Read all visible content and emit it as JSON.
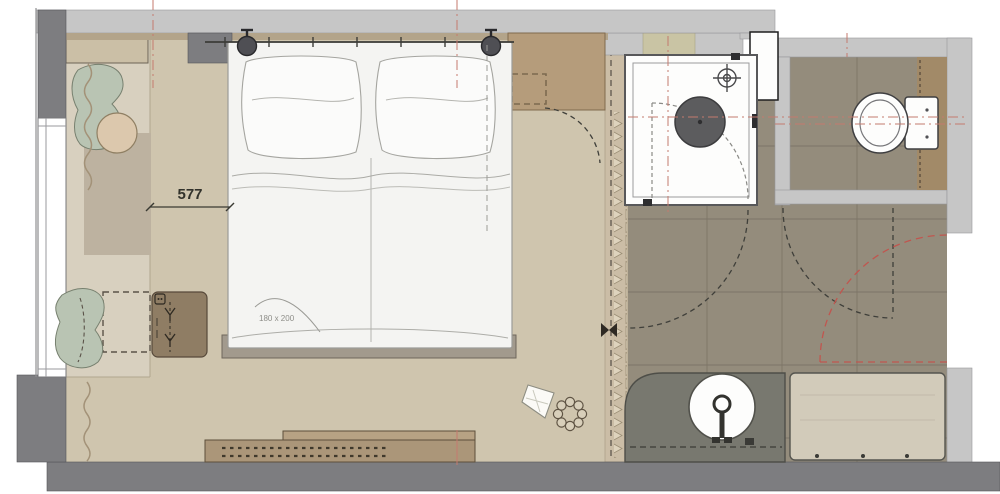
{
  "plan": {
    "dimension_label": "577",
    "bed_size_label": "180 x 200"
  },
  "colors": {
    "wall_light": "#c6c6c6",
    "wall_dark": "#7d7d80",
    "floor_bedroom": "#cfc5ae",
    "floor_bay": "#d8d0bf",
    "floor_bath": "#948c7c",
    "rug": "#bdb2a0",
    "wood_dark": "#b59c7b",
    "wood_mid": "#ab9679",
    "wood_partition": "#cbbda6",
    "wood_install": "#a28a68",
    "sage": "#b9c4b3",
    "fixture_white": "#fdfdfc",
    "bed_white": "#f4f4f2",
    "vanity_gray": "#78786f",
    "bench_beige": "#d2cbba",
    "line_dark": "#3f3f3a",
    "accent_red": "#c0564f",
    "centerline_red": "#c47a6e"
  }
}
